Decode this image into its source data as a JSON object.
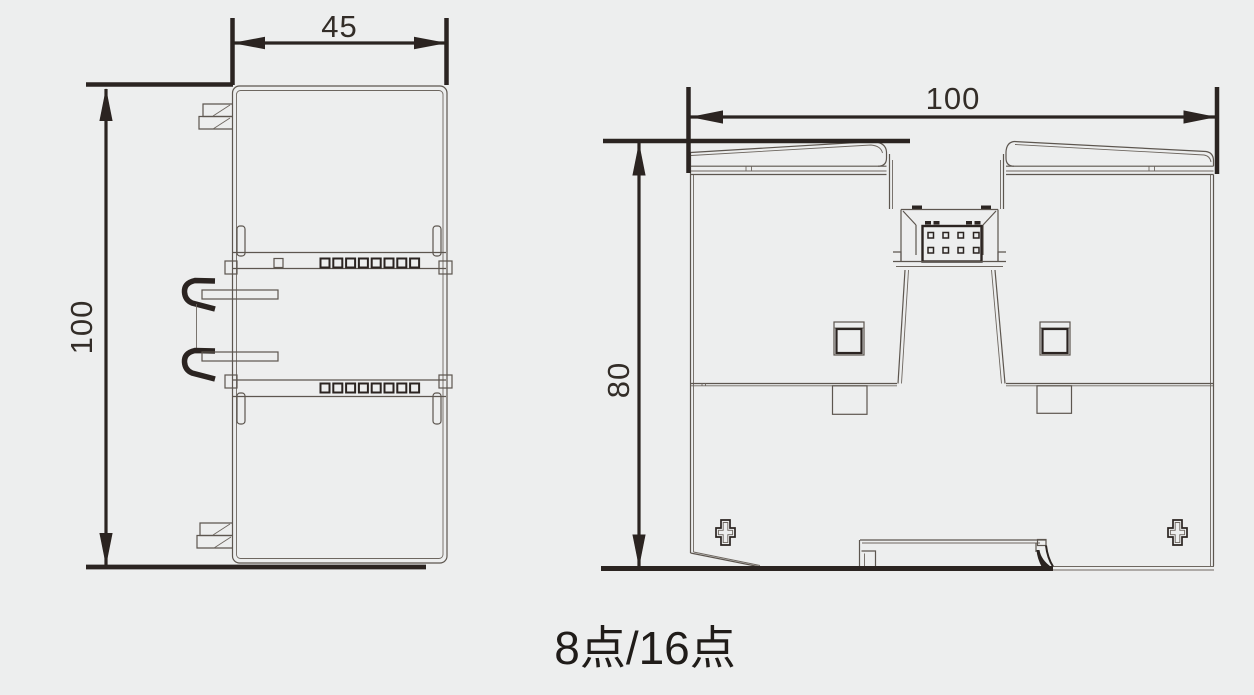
{
  "drawing": {
    "caption": "8点/16点",
    "side_view": {
      "label": "side-view",
      "width_dim": "45",
      "height_dim": "100"
    },
    "rear_view": {
      "label": "rear-view",
      "width_dim": "100",
      "height_dim": "80"
    },
    "units_note": "mm"
  },
  "colors": {
    "background": "#edeeee",
    "line_heavy": "#2b2421",
    "line_thin": "#5d564f",
    "text": "#332d28"
  }
}
